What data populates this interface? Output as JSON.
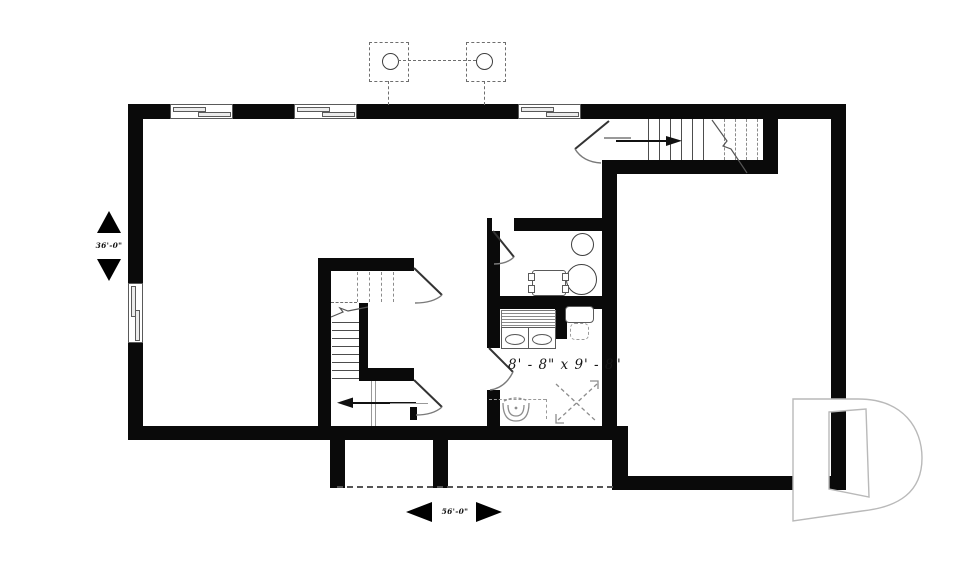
{
  "plan": {
    "title": "basement floor plan",
    "annotations": {
      "dimension_left": "36'-0\"",
      "dimension_bottom": "56'-0\"",
      "room_size_label": "8' - 8\" x 9' - 8\""
    },
    "watermark": {
      "logo_letter": "D"
    },
    "colors": {
      "wall": "#0a0a0a",
      "thin_line": "#474747",
      "dashed_line": "#6e6e6e",
      "door_arc": "#7a7a7a",
      "watermark_outline": "#b9b9b9",
      "background": "#ffffff"
    },
    "icons": {
      "post-above-icon": "dashed square with circle (post above)",
      "window-icon": "sliding window glyph",
      "door-swing-icon": "door leaf with quarter-circle arc",
      "stair-arrow-icon": "direction arrow on stair run",
      "toilet-icon": "toilet rough-in",
      "shower-roughin-icon": "dashed X square",
      "water-heater-icon": "circle",
      "furnace-icon": "rectangle with side tabs",
      "vanity-sink-icon": "cabinet with oval sink",
      "dimension-arrow-icon": "solid triangle"
    }
  }
}
